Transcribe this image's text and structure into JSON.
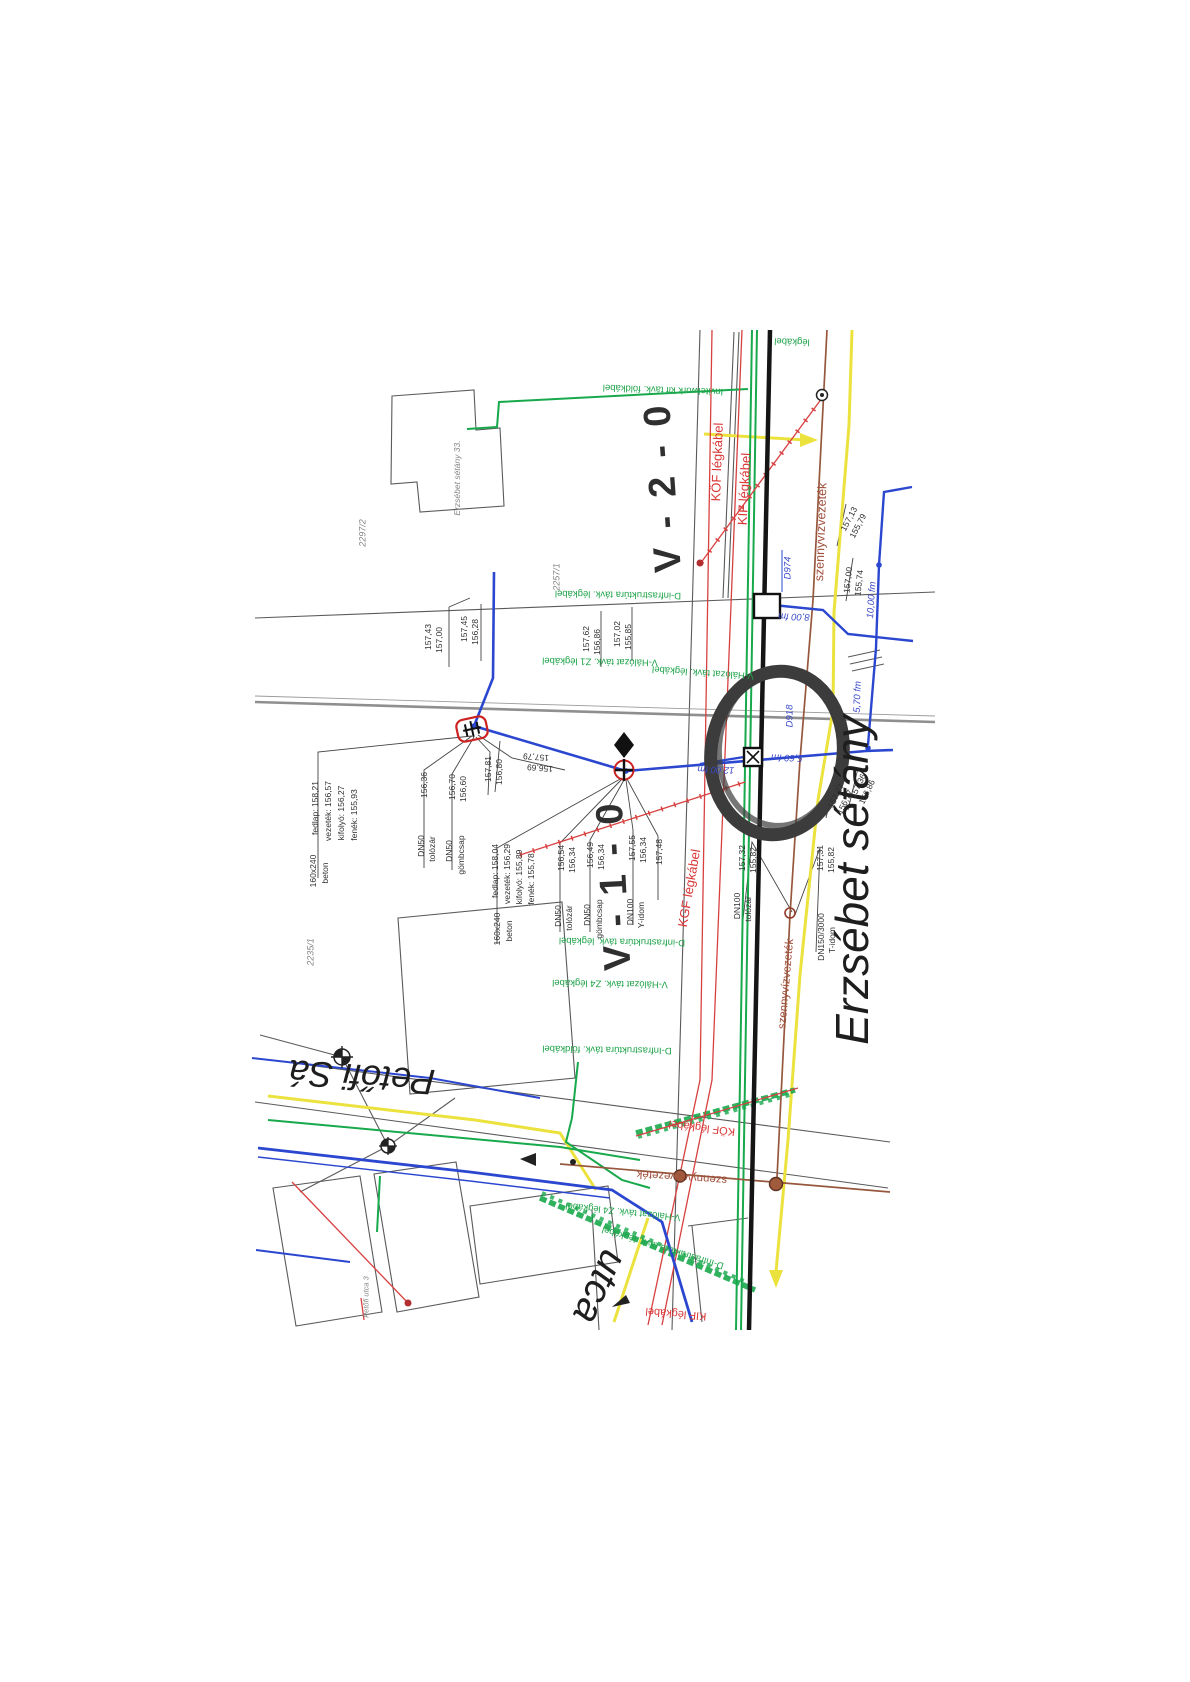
{
  "document": {
    "type": "scanned utility map (közműtérkép)",
    "annotation": "hand-drawn-marker-circle"
  },
  "colors": {
    "ink": "#1e1e1e",
    "ink2": "#2f2f2f",
    "gray": "#858585",
    "red": "#d93636",
    "brown": "#a0503c",
    "blue": "#3a49c8",
    "green": "#1fa34a",
    "water": "#2b47cf",
    "gas": "#ece23e",
    "sewer": "#96573d",
    "telecom": "#18a94c",
    "power": "#d84040",
    "street": "#151515",
    "marker": "#3c3c3c"
  },
  "map_labels": [
    {
      "n": "street-name-erzsebet-setany",
      "t": "Erzsébet sétány",
      "x": 852,
      "y": 880,
      "r": -90,
      "s": 46,
      "c": "ink",
      "i": 1
    },
    {
      "n": "street-name-petofi",
      "t": "Petőfi Sá",
      "x": 362,
      "y": 1077,
      "r": 184,
      "s": 36,
      "c": "ink",
      "i": 1
    },
    {
      "n": "street-name-utca",
      "t": "utca",
      "x": 600,
      "y": 1287,
      "r": 115,
      "s": 40,
      "c": "ink",
      "i": 1
    },
    {
      "n": "marker-v-1-0",
      "t": "V - 1 - 0",
      "x": 614,
      "y": 885,
      "r": -93,
      "s": 38,
      "c": "ink2",
      "w": 700,
      "ls": 4
    },
    {
      "n": "marker-v-2-0",
      "t": "V - 2 - 0",
      "x": 663,
      "y": 487,
      "r": -94,
      "s": 38,
      "c": "ink2",
      "w": 700,
      "ls": 4
    },
    {
      "n": "power-line-label",
      "t": "KÖF légkábel",
      "x": 717,
      "y": 462,
      "r": -88,
      "s": 13,
      "c": "red"
    },
    {
      "n": "power-line-label",
      "t": "KIF légkábel",
      "x": 744,
      "y": 489,
      "r": -87,
      "s": 13,
      "c": "red"
    },
    {
      "n": "power-line-label",
      "t": "KGF légkábel",
      "x": 689,
      "y": 888,
      "r": -80,
      "s": 13,
      "c": "red"
    },
    {
      "n": "power-line-label",
      "t": "KÖF légkábel",
      "x": 702,
      "y": 1127,
      "r": 187,
      "s": 11,
      "c": "red"
    },
    {
      "n": "power-line-label",
      "t": "KIF légkábel",
      "x": 676,
      "y": 1313,
      "r": 185,
      "s": 11,
      "c": "red"
    },
    {
      "n": "sewer-line-label",
      "t": "szennyvízvezeték",
      "x": 821,
      "y": 532,
      "r": -88,
      "s": 12.5,
      "c": "brown"
    },
    {
      "n": "sewer-line-label",
      "t": "szennyvízvezeték",
      "x": 787,
      "y": 984,
      "r": -85,
      "s": 11.5,
      "c": "brown"
    },
    {
      "n": "sewer-line-label",
      "t": "szennyvízvezeték",
      "x": 682,
      "y": 1176,
      "r": 184,
      "s": 11.5,
      "c": "brown"
    },
    {
      "n": "water-dim-label",
      "t": "D974",
      "x": 788,
      "y": 568,
      "r": -90,
      "s": 9.5,
      "c": "blue",
      "i": 1
    },
    {
      "n": "water-dim-label",
      "t": "8,00 fm",
      "x": 794,
      "y": 616,
      "r": 182,
      "s": 9.5,
      "c": "blue",
      "i": 1
    },
    {
      "n": "water-dim-label",
      "t": "10,00 fm",
      "x": 872,
      "y": 600,
      "r": -86,
      "s": 9.5,
      "c": "blue",
      "i": 1
    },
    {
      "n": "water-dim-label",
      "t": "5,70 fm",
      "x": 858,
      "y": 697,
      "r": -88,
      "s": 9.5,
      "c": "blue",
      "i": 1
    },
    {
      "n": "water-dim-label",
      "t": "D918",
      "x": 790,
      "y": 716,
      "r": -90,
      "s": 9.5,
      "c": "blue",
      "i": 1
    },
    {
      "n": "water-dim-label",
      "t": "5,60 fm",
      "x": 787,
      "y": 757,
      "r": 182,
      "s": 9.5,
      "c": "blue",
      "i": 1
    },
    {
      "n": "water-dim-label",
      "t": "12,00 fm",
      "x": 716,
      "y": 769,
      "r": 182,
      "s": 9.5,
      "c": "blue",
      "i": 1
    },
    {
      "n": "telecom-line-label",
      "t": "Invitelwork kif távk. földkábel",
      "x": 663,
      "y": 389,
      "r": 182,
      "s": 9.5,
      "c": "green"
    },
    {
      "n": "telecom-line-label",
      "t": "légkábel",
      "x": 792,
      "y": 341,
      "r": 182,
      "s": 9.5,
      "c": "green"
    },
    {
      "n": "telecom-line-label",
      "t": "D-infrastruktúra távk. légkábel",
      "x": 618,
      "y": 594,
      "r": 181,
      "s": 9.5,
      "c": "green"
    },
    {
      "n": "telecom-line-label",
      "t": "V-Hálózat távk. Z1 légkábel",
      "x": 600,
      "y": 661,
      "r": 181,
      "s": 9.5,
      "c": "green"
    },
    {
      "n": "telecom-line-label",
      "t": "V-Hálózat távk. légkábel",
      "x": 703,
      "y": 672,
      "r": 184,
      "s": 9.5,
      "c": "green"
    },
    {
      "n": "telecom-line-label",
      "t": "D-infrastruktúra távk. légkábel",
      "x": 622,
      "y": 941,
      "r": 181,
      "s": 9.5,
      "c": "green"
    },
    {
      "n": "telecom-line-label",
      "t": "V-Hálózat távk. Z4 légkábel",
      "x": 610,
      "y": 983,
      "r": 181,
      "s": 9.5,
      "c": "green"
    },
    {
      "n": "telecom-line-label",
      "t": "D-Infrastruktúra távk. földkábel",
      "x": 607,
      "y": 1049,
      "r": 181,
      "s": 9.5,
      "c": "green"
    },
    {
      "n": "telecom-line-label",
      "t": "V-Hálózat távk. Z4 légkábel",
      "x": 623,
      "y": 1211,
      "r": 186,
      "s": 9.5,
      "c": "green"
    },
    {
      "n": "telecom-line-label",
      "t": "D-Infrastruktúra távk. légkábel",
      "x": 663,
      "y": 1247,
      "r": 197,
      "s": 9.5,
      "c": "green"
    },
    {
      "n": "elevation-label",
      "t": "157,43",
      "x": 428,
      "y": 637
    },
    {
      "n": "elevation-label",
      "t": "157,00",
      "x": 439,
      "y": 640
    },
    {
      "n": "elevation-label",
      "t": "157,45",
      "x": 464,
      "y": 629
    },
    {
      "n": "elevation-label",
      "t": "156,28",
      "x": 475,
      "y": 632
    },
    {
      "n": "elevation-label",
      "t": "157,62",
      "x": 586,
      "y": 639
    },
    {
      "n": "elevation-label",
      "t": "156,86",
      "x": 597,
      "y": 642
    },
    {
      "n": "elevation-label",
      "t": "157,02",
      "x": 617,
      "y": 634
    },
    {
      "n": "elevation-label",
      "t": "155,85",
      "x": 628,
      "y": 637
    },
    {
      "n": "elevation-label",
      "t": "157,79",
      "x": 536,
      "y": 757,
      "r": 184
    },
    {
      "n": "elevation-label",
      "t": "156,69",
      "x": 540,
      "y": 768,
      "r": 184
    },
    {
      "n": "fitting-label",
      "t": "fedlap: 158,21",
      "x": 315,
      "y": 808
    },
    {
      "n": "fitting-label",
      "t": "vezeték: 156,57",
      "x": 328,
      "y": 811
    },
    {
      "n": "fitting-label",
      "t": "kifolyó: 156,27",
      "x": 341,
      "y": 813
    },
    {
      "n": "fitting-label",
      "t": "fenék: 155,93",
      "x": 354,
      "y": 815
    },
    {
      "n": "fitting-label",
      "t": "160x240",
      "x": 313,
      "y": 871
    },
    {
      "n": "fitting-label",
      "t": "beton",
      "x": 325,
      "y": 873
    },
    {
      "n": "fitting-label",
      "t": "156,36",
      "x": 424,
      "y": 785
    },
    {
      "n": "fitting-label",
      "t": "DN50",
      "x": 421,
      "y": 846
    },
    {
      "n": "fitting-label",
      "t": "tolózár",
      "x": 432,
      "y": 849
    },
    {
      "n": "fitting-label",
      "t": "156,70",
      "x": 452,
      "y": 787
    },
    {
      "n": "fitting-label",
      "t": "156,60",
      "x": 463,
      "y": 789
    },
    {
      "n": "fitting-label",
      "t": "DN50",
      "x": 449,
      "y": 851
    },
    {
      "n": "fitting-label",
      "t": "gömbcsap",
      "x": 461,
      "y": 855
    },
    {
      "n": "elevation-label",
      "t": "157,81",
      "x": 488,
      "y": 769
    },
    {
      "n": "elevation-label",
      "t": "156,80",
      "x": 499,
      "y": 772
    },
    {
      "n": "fitting-label",
      "t": "fedlap: 158,04",
      "x": 495,
      "y": 871
    },
    {
      "n": "fitting-label",
      "t": "vezeték: 156,29",
      "x": 507,
      "y": 874
    },
    {
      "n": "fitting-label",
      "t": "kifolyó: 155,89",
      "x": 519,
      "y": 877
    },
    {
      "n": "fitting-label",
      "t": "fenék: 155,78",
      "x": 531,
      "y": 879
    },
    {
      "n": "fitting-label",
      "t": "160x240",
      "x": 497,
      "y": 929
    },
    {
      "n": "fitting-label",
      "t": "beton",
      "x": 509,
      "y": 931
    },
    {
      "n": "fitting-label",
      "t": "156,54",
      "x": 561,
      "y": 858
    },
    {
      "n": "fitting-label",
      "t": "156,34",
      "x": 572,
      "y": 860
    },
    {
      "n": "fitting-label",
      "t": "DN50",
      "x": 558,
      "y": 916
    },
    {
      "n": "fitting-label",
      "t": "tolózár",
      "x": 569,
      "y": 918
    },
    {
      "n": "fitting-label",
      "t": "156,49",
      "x": 590,
      "y": 855
    },
    {
      "n": "fitting-label",
      "t": "156,34",
      "x": 601,
      "y": 857
    },
    {
      "n": "fitting-label",
      "t": "DN50",
      "x": 587,
      "y": 915
    },
    {
      "n": "fitting-label",
      "t": "gömbcsap",
      "x": 599,
      "y": 919
    },
    {
      "n": "fitting-label",
      "t": "157,55",
      "x": 632,
      "y": 848
    },
    {
      "n": "fitting-label",
      "t": "156,34",
      "x": 643,
      "y": 850
    },
    {
      "n": "fitting-label",
      "t": "DN100",
      "x": 630,
      "y": 912
    },
    {
      "n": "fitting-label",
      "t": "Y-idom",
      "x": 641,
      "y": 915
    },
    {
      "n": "elevation-label",
      "t": "157,48",
      "x": 659,
      "y": 852
    },
    {
      "n": "fitting-label",
      "t": "157,32",
      "x": 742,
      "y": 858
    },
    {
      "n": "fitting-label",
      "t": "155,82",
      "x": 753,
      "y": 860
    },
    {
      "n": "fitting-label",
      "t": "DN100",
      "x": 737,
      "y": 906
    },
    {
      "n": "fitting-label",
      "t": "tolózár",
      "x": 748,
      "y": 909
    },
    {
      "n": "fitting-label",
      "t": "157,31",
      "x": 820,
      "y": 858
    },
    {
      "n": "fitting-label",
      "t": "155,82",
      "x": 831,
      "y": 860
    },
    {
      "n": "fitting-label",
      "t": "DN150/3000",
      "x": 821,
      "y": 937
    },
    {
      "n": "fitting-label",
      "t": "T-idom",
      "x": 832,
      "y": 940
    },
    {
      "n": "elevation-label",
      "t": "157,13",
      "x": 849,
      "y": 519,
      "r": -62
    },
    {
      "n": "elevation-label",
      "t": "155,79",
      "x": 858,
      "y": 526,
      "r": -62
    },
    {
      "n": "elevation-label",
      "t": "157,00",
      "x": 848,
      "y": 580,
      "r": -84
    },
    {
      "n": "elevation-label",
      "t": "155,74",
      "x": 859,
      "y": 583,
      "r": -84
    },
    {
      "n": "elevation-label",
      "t": "157,27",
      "x": 836,
      "y": 796,
      "r": -64
    },
    {
      "n": "elevation-label",
      "t": "156,77",
      "x": 845,
      "y": 802,
      "r": -64
    },
    {
      "n": "elevation-label",
      "t": "157,36",
      "x": 858,
      "y": 786,
      "r": -64
    },
    {
      "n": "elevation-label",
      "t": "156,86",
      "x": 867,
      "y": 792,
      "r": -64
    },
    {
      "n": "parcel-number",
      "t": "2235/1",
      "x": 311,
      "y": 952,
      "c": "gray",
      "i": 1,
      "s": 9
    },
    {
      "n": "parcel-number",
      "t": "2297/2",
      "x": 363,
      "y": 533,
      "c": "gray",
      "i": 1,
      "s": 9
    },
    {
      "n": "parcel-number",
      "t": "2257/1",
      "x": 557,
      "y": 577,
      "c": "gray",
      "i": 1,
      "s": 9
    },
    {
      "n": "building-label",
      "t": "Erzsébet sétány 33.",
      "x": 457,
      "y": 478,
      "c": "gray",
      "i": 1,
      "s": 8.5
    },
    {
      "n": "building-label",
      "t": "Petőfi utca 3",
      "x": 366,
      "y": 1297,
      "c": "gray",
      "i": 1,
      "s": 7.5
    }
  ]
}
